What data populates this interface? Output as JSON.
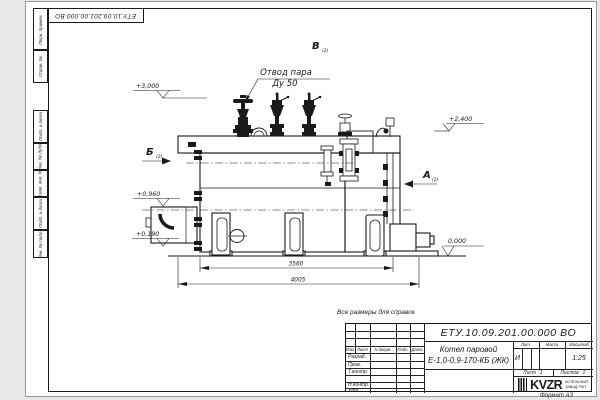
{
  "sheet": {
    "background": "#e8e8e8",
    "paper": "#ffffff",
    "line_color": "#1a1a1a",
    "corner_stamp": "ЕТУ.10.09.201.00.000 ВО",
    "reference_note": "Все размеры для справок",
    "format_note": "Формат А3",
    "margin_boxes": [
      "Перв. примен.",
      "Справ. №",
      "Подп. и дата",
      "Инв. № дубл.",
      "Взам. инв. №",
      "Подп. и дата",
      "Инв. № подл."
    ]
  },
  "drawing": {
    "callout": {
      "line1": "Отвод пара",
      "line2": "Ду 50"
    },
    "views": {
      "b": "Б",
      "v": "В",
      "a": "А",
      "sheet_ref": "(2)"
    },
    "elevations": {
      "top": "+3,000",
      "rear_top": "+2,400",
      "burner": "+0,960",
      "low": "+0,190",
      "ground": "0,000"
    },
    "dimensions": {
      "inner": "3560",
      "overall": "4005"
    }
  },
  "title_block": {
    "doc_number": "ЕТУ.10.09.201.00.000 ВО",
    "product": {
      "line1": "Котел паровой",
      "line2": "Е-1,0-0,9-170-КБ (ЖК)"
    },
    "columns": {
      "izm": "Изм.",
      "list": "Лист",
      "doc": "N докум.",
      "podp": "Подп.",
      "data": "Дата"
    },
    "rows": {
      "razrab": "Разраб.",
      "prov": "Пров.",
      "tkontr": "Т.контр.",
      "nkontr": "Н.контр.",
      "utv": "Утв."
    },
    "stats": {
      "lit_label": "Лит.",
      "lit_value": "И",
      "mass_label": "Масса",
      "scale_label": "Масштаб",
      "scale_value": "1:25"
    },
    "sheet_info": {
      "list_label": "Лист",
      "list_value": "1",
      "listov_label": "Листов",
      "listov_value": "2"
    },
    "logo": {
      "text": "KVZR",
      "caption1": "КОТЕЛЬНЫЙ",
      "caption2": "ЗАВОД РЭП"
    }
  }
}
